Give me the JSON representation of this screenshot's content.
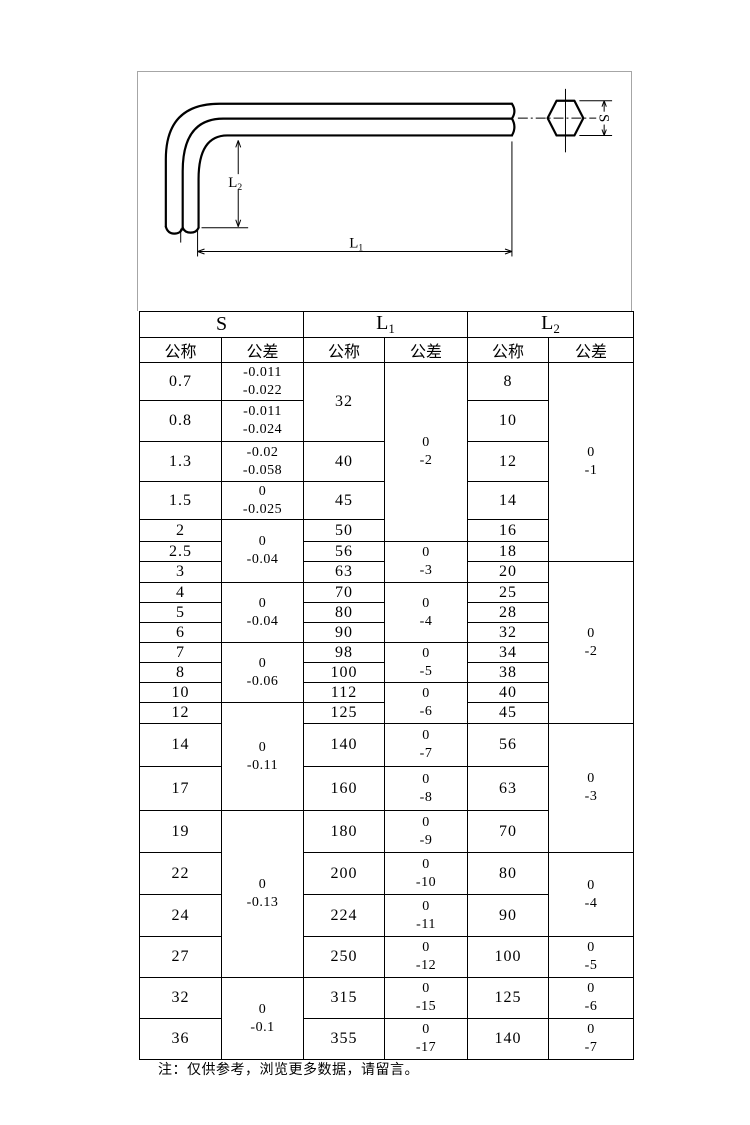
{
  "page": {
    "note": "注：仅供参考，浏览更多数据，请留言。"
  },
  "drawing": {
    "labels": {
      "l1": {
        "base": "L",
        "sub": "1"
      },
      "l2": {
        "base": "L",
        "sub": "2"
      },
      "s": {
        "base": "S",
        "sub": ""
      }
    }
  },
  "table": {
    "column_groups": [
      {
        "base": "S",
        "sub": ""
      },
      {
        "base": "L",
        "sub": "1"
      },
      {
        "base": "L",
        "sub": "2"
      }
    ],
    "subheaders": {
      "nominal": "公称",
      "tolerance": "公差"
    },
    "rows": [
      {
        "h": 38,
        "cells": [
          [
            "s",
            "0.7",
            1
          ],
          [
            "st",
            [
              "-0.011",
              "-0.022"
            ],
            1
          ],
          [
            "l1",
            "32",
            2
          ],
          [
            "l1t",
            [
              "0",
              "-2"
            ],
            5
          ],
          [
            "l2",
            "8",
            1
          ],
          [
            "l2t",
            [
              "0",
              "-1"
            ],
            6
          ]
        ]
      },
      {
        "h": 41,
        "cells": [
          [
            "s",
            "0.8",
            1
          ],
          [
            "st",
            [
              "-0.011",
              "-0.024"
            ],
            1
          ],
          [
            "l2",
            "10",
            1
          ]
        ]
      },
      {
        "h": 40,
        "cells": [
          [
            "s",
            "1.3",
            1
          ],
          [
            "st",
            [
              "-0.02",
              "-0.058"
            ],
            1
          ],
          [
            "l1",
            "40",
            1
          ],
          [
            "l2",
            "12",
            1
          ]
        ]
      },
      {
        "h": 38,
        "cells": [
          [
            "s",
            "1.5",
            1
          ],
          [
            "st",
            [
              "0",
              "-0.025"
            ],
            1
          ],
          [
            "l1",
            "45",
            1
          ],
          [
            "l2",
            "14",
            1
          ]
        ]
      },
      {
        "h": 22,
        "cells": [
          [
            "s",
            "2",
            1
          ],
          [
            "st",
            [
              "0",
              "-0.04"
            ],
            3
          ],
          [
            "l1",
            "50",
            1
          ],
          [
            "l2",
            "16",
            1
          ]
        ]
      },
      {
        "h": 20,
        "cells": [
          [
            "s",
            "2.5",
            1
          ],
          [
            "l1",
            "56",
            1
          ],
          [
            "l1t",
            [
              "0",
              "-3"
            ],
            2
          ],
          [
            "l2",
            "18",
            1
          ]
        ]
      },
      {
        "h": 21,
        "cells": [
          [
            "s",
            "3",
            1
          ],
          [
            "l1",
            "63",
            1
          ],
          [
            "l2",
            "20",
            1
          ],
          [
            "l2t",
            [
              "0",
              "-2"
            ],
            8
          ]
        ]
      },
      {
        "h": 20,
        "cells": [
          [
            "s",
            "4",
            1
          ],
          [
            "st",
            [
              "0",
              "-0.04"
            ],
            3
          ],
          [
            "l1",
            "70",
            1
          ],
          [
            "l1t",
            [
              "0",
              "-4"
            ],
            3
          ],
          [
            "l2",
            "25",
            1
          ]
        ]
      },
      {
        "h": 20,
        "cells": [
          [
            "s",
            "5",
            1
          ],
          [
            "l1",
            "80",
            1
          ],
          [
            "l2",
            "28",
            1
          ]
        ]
      },
      {
        "h": 20,
        "cells": [
          [
            "s",
            "6",
            1
          ],
          [
            "l1",
            "90",
            1
          ],
          [
            "l2",
            "32",
            1
          ]
        ]
      },
      {
        "h": 20,
        "cells": [
          [
            "s",
            "7",
            1
          ],
          [
            "st",
            [
              "0",
              "-0.06"
            ],
            3
          ],
          [
            "l1",
            "98",
            1
          ],
          [
            "l1t",
            [
              "0",
              "-5"
            ],
            2
          ],
          [
            "l2",
            "34",
            1
          ]
        ]
      },
      {
        "h": 20,
        "cells": [
          [
            "s",
            "8",
            1
          ],
          [
            "l1",
            "100",
            1
          ],
          [
            "l2",
            "38",
            1
          ]
        ]
      },
      {
        "h": 20,
        "cells": [
          [
            "s",
            "10",
            1
          ],
          [
            "l1",
            "112",
            1
          ],
          [
            "l1t",
            [
              "0",
              "-6"
            ],
            2
          ],
          [
            "l2",
            "40",
            1
          ]
        ]
      },
      {
        "h": 21,
        "cells": [
          [
            "s",
            "12",
            1
          ],
          [
            "st",
            [
              "0",
              "-0.11"
            ],
            3
          ],
          [
            "l1",
            "125",
            1
          ],
          [
            "l2",
            "45",
            1
          ]
        ]
      },
      {
        "h": 43,
        "cells": [
          [
            "s",
            "14",
            1
          ],
          [
            "l1",
            "140",
            1
          ],
          [
            "l1t",
            [
              "0",
              "-7"
            ],
            1
          ],
          [
            "l2",
            "56",
            1
          ],
          [
            "l2t",
            [
              "0",
              "-3"
            ],
            3
          ]
        ]
      },
      {
        "h": 44,
        "cells": [
          [
            "s",
            "17",
            1
          ],
          [
            "l1",
            "160",
            1
          ],
          [
            "l1t",
            [
              "0",
              "-8"
            ],
            1
          ],
          [
            "l2",
            "63",
            1
          ]
        ]
      },
      {
        "h": 42,
        "cells": [
          [
            "s",
            "19",
            1
          ],
          [
            "st",
            [
              "0",
              "-0.13"
            ],
            4
          ],
          [
            "l1",
            "180",
            1
          ],
          [
            "l1t",
            [
              "0",
              "-9"
            ],
            1
          ],
          [
            "l2",
            "70",
            1
          ]
        ]
      },
      {
        "h": 42,
        "cells": [
          [
            "s",
            "22",
            1
          ],
          [
            "l1",
            "200",
            1
          ],
          [
            "l1t",
            [
              "0",
              "-10"
            ],
            1
          ],
          [
            "l2",
            "80",
            1
          ],
          [
            "l2t",
            [
              "0",
              "-4"
            ],
            2
          ]
        ]
      },
      {
        "h": 42,
        "cells": [
          [
            "s",
            "24",
            1
          ],
          [
            "l1",
            "224",
            1
          ],
          [
            "l1t",
            [
              "0",
              "-11"
            ],
            1
          ],
          [
            "l2",
            "90",
            1
          ]
        ]
      },
      {
        "h": 41,
        "cells": [
          [
            "s",
            "27",
            1
          ],
          [
            "l1",
            "250",
            1
          ],
          [
            "l1t",
            [
              "0",
              "-12"
            ],
            1
          ],
          [
            "l2",
            "100",
            1
          ],
          [
            "l2t",
            [
              "0",
              "-5"
            ],
            1
          ]
        ]
      },
      {
        "h": 41,
        "cells": [
          [
            "s",
            "32",
            1
          ],
          [
            "st",
            [
              "0",
              "-0.1"
            ],
            2
          ],
          [
            "l1",
            "315",
            1
          ],
          [
            "l1t",
            [
              "0",
              "-15"
            ],
            1
          ],
          [
            "l2",
            "125",
            1
          ],
          [
            "l2t",
            [
              "0",
              "-6"
            ],
            1
          ]
        ]
      },
      {
        "h": 41,
        "cells": [
          [
            "s",
            "36",
            1
          ],
          [
            "l1",
            "355",
            1
          ],
          [
            "l1t",
            [
              "0",
              "-17"
            ],
            1
          ],
          [
            "l2",
            "140",
            1
          ],
          [
            "l2t",
            [
              "0",
              "-7"
            ],
            1
          ]
        ]
      }
    ]
  }
}
